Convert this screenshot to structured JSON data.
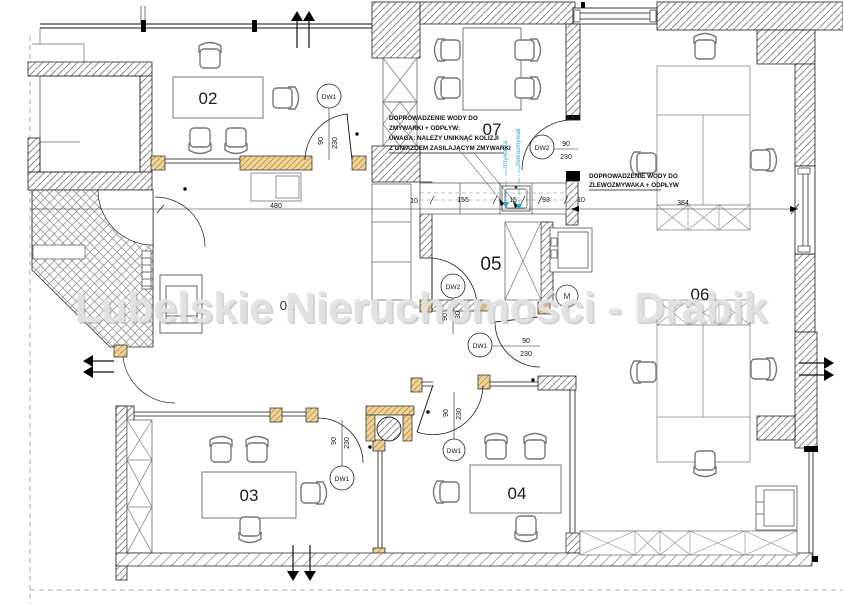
{
  "watermark": "Lubelskie Nieruchomości - Drabik",
  "rooms": {
    "r01": "01",
    "r02": "02",
    "r03": "03",
    "r04": "04",
    "r05": "05",
    "r06": "06",
    "r07": "07"
  },
  "doors": {
    "d02": {
      "tag": "DW1",
      "w": "90",
      "h": "230"
    },
    "d07": {
      "tag": "DW2",
      "w": "90",
      "h": "230"
    },
    "d05": {
      "tag": "DW2",
      "w": "90",
      "h": "230"
    },
    "dhall": {
      "tag": "DW1",
      "w": "90",
      "h": "230"
    },
    "d03": {
      "tag": "DW1",
      "w": "90",
      "h": "230"
    },
    "d04": {
      "tag": "DW1",
      "w": "90",
      "h": "230"
    }
  },
  "dims": {
    "desk": "480",
    "c10l": "10",
    "c155": "155",
    "c15": "15",
    "c93": "93",
    "c10r": "10",
    "win": "384"
  },
  "notes": {
    "dishwasher": {
      "l1": "DOPROWADZENIE WODY DO",
      "l2": "ZMYWARKI + ODPŁYW:",
      "l3": "UWAGA: NALEŻY UNIKNĄĆ KOLIZJI",
      "l4": "Z GNIAZDEM ZASILAJĄCYM ZMYWARKI"
    },
    "sink": {
      "l1": "DOPROWADZENIE WODY DO",
      "l2": "ZLEWOZMYWAKA + ODPŁYW"
    },
    "labels": {
      "dishwasher": "zmywarka",
      "sink": "zlewozmywak"
    }
  },
  "symbols": {
    "meter": "M"
  },
  "colors": {
    "threshold": "#ecd39e",
    "threshold_hatch": "#c8913c",
    "blue": "#2fa8c8",
    "wall_hatch": "#8a8a8a",
    "watermark": "#dedede"
  }
}
